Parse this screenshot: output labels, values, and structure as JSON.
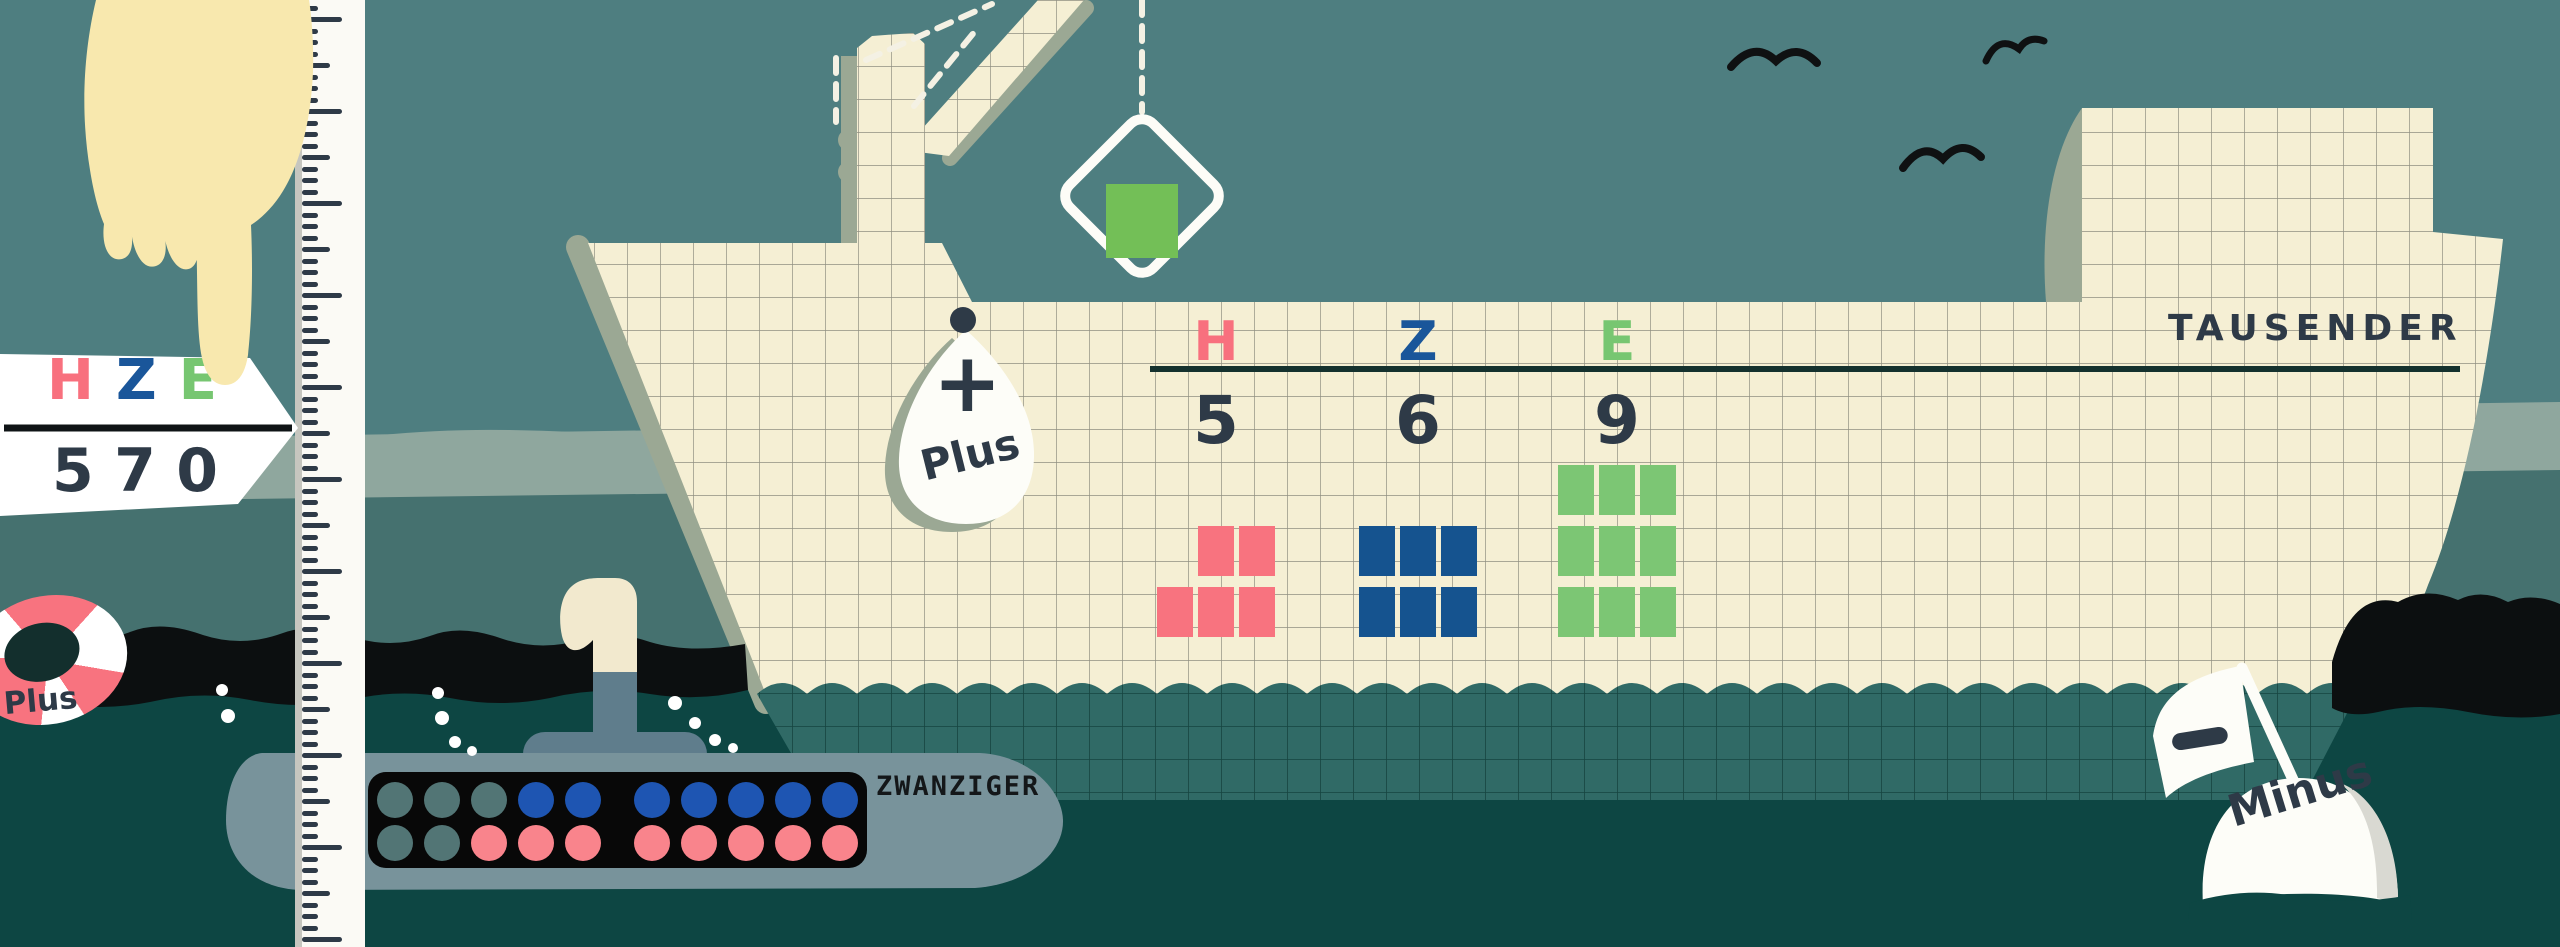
{
  "colors": {
    "sky": "#4E7E80",
    "shore_band": "#8FA79E",
    "sea": "#45716F",
    "deep_water": "#0D4643",
    "wave_black": "#0C0F10",
    "paper": "#F5EFD4",
    "underwater_hull": "#306A66",
    "shadow": "#9BA894",
    "ink": "#2E3A47",
    "pink": "#F8737F",
    "blue": "#15538F",
    "green": "#7CC674",
    "crane_green": "#73BF57",
    "dot_blue": "#1E55B2",
    "dot_pink": "#F9848C",
    "dot_empty": "#527575",
    "sub_body": "#78939B",
    "sub_blue": "#5F7D8C",
    "hand": "#F8E8AE",
    "white": "#FDFDF8"
  },
  "pointer_sign": {
    "letters": [
      {
        "char": "H",
        "color": "#F8707E"
      },
      {
        "char": "Z",
        "color": "#1A569A"
      },
      {
        "char": "E",
        "color": "#77C671"
      }
    ],
    "digits": [
      "5",
      "7",
      "0"
    ]
  },
  "ship": {
    "thousands_label": "TAUSENDER",
    "plus_buoy": {
      "symbol": "+",
      "label": "Plus"
    },
    "columns": [
      {
        "letter": "H",
        "letter_color": "#F8707E",
        "digit": "5",
        "block_color": "#F8737F",
        "blocks": 5,
        "arrangement": [
          [
            0,
            1,
            1
          ],
          [
            1,
            1,
            1
          ]
        ]
      },
      {
        "letter": "Z",
        "letter_color": "#1A569A",
        "digit": "6",
        "block_color": "#15538F",
        "blocks": 6,
        "arrangement": [
          [
            1,
            1,
            1
          ],
          [
            1,
            1,
            1
          ]
        ]
      },
      {
        "letter": "E",
        "letter_color": "#77C671",
        "digit": "9",
        "block_color": "#7CC674",
        "blocks": 9,
        "arrangement": [
          [
            1,
            1,
            1
          ],
          [
            1,
            1,
            1
          ],
          [
            1,
            1,
            1
          ]
        ]
      }
    ],
    "crane_block_color": "#73BF57"
  },
  "submarine": {
    "label": "ZWANZIGER",
    "rows": [
      [
        "empty",
        "empty",
        "empty",
        "blue",
        "blue",
        "blue",
        "blue",
        "blue",
        "blue",
        "blue"
      ],
      [
        "empty",
        "empty",
        "pink",
        "pink",
        "pink",
        "pink",
        "pink",
        "pink",
        "pink",
        "pink"
      ]
    ]
  },
  "minus_buoy": {
    "symbol": "−",
    "label": "Minus"
  },
  "lifebuoy": {
    "label": "Plus"
  }
}
